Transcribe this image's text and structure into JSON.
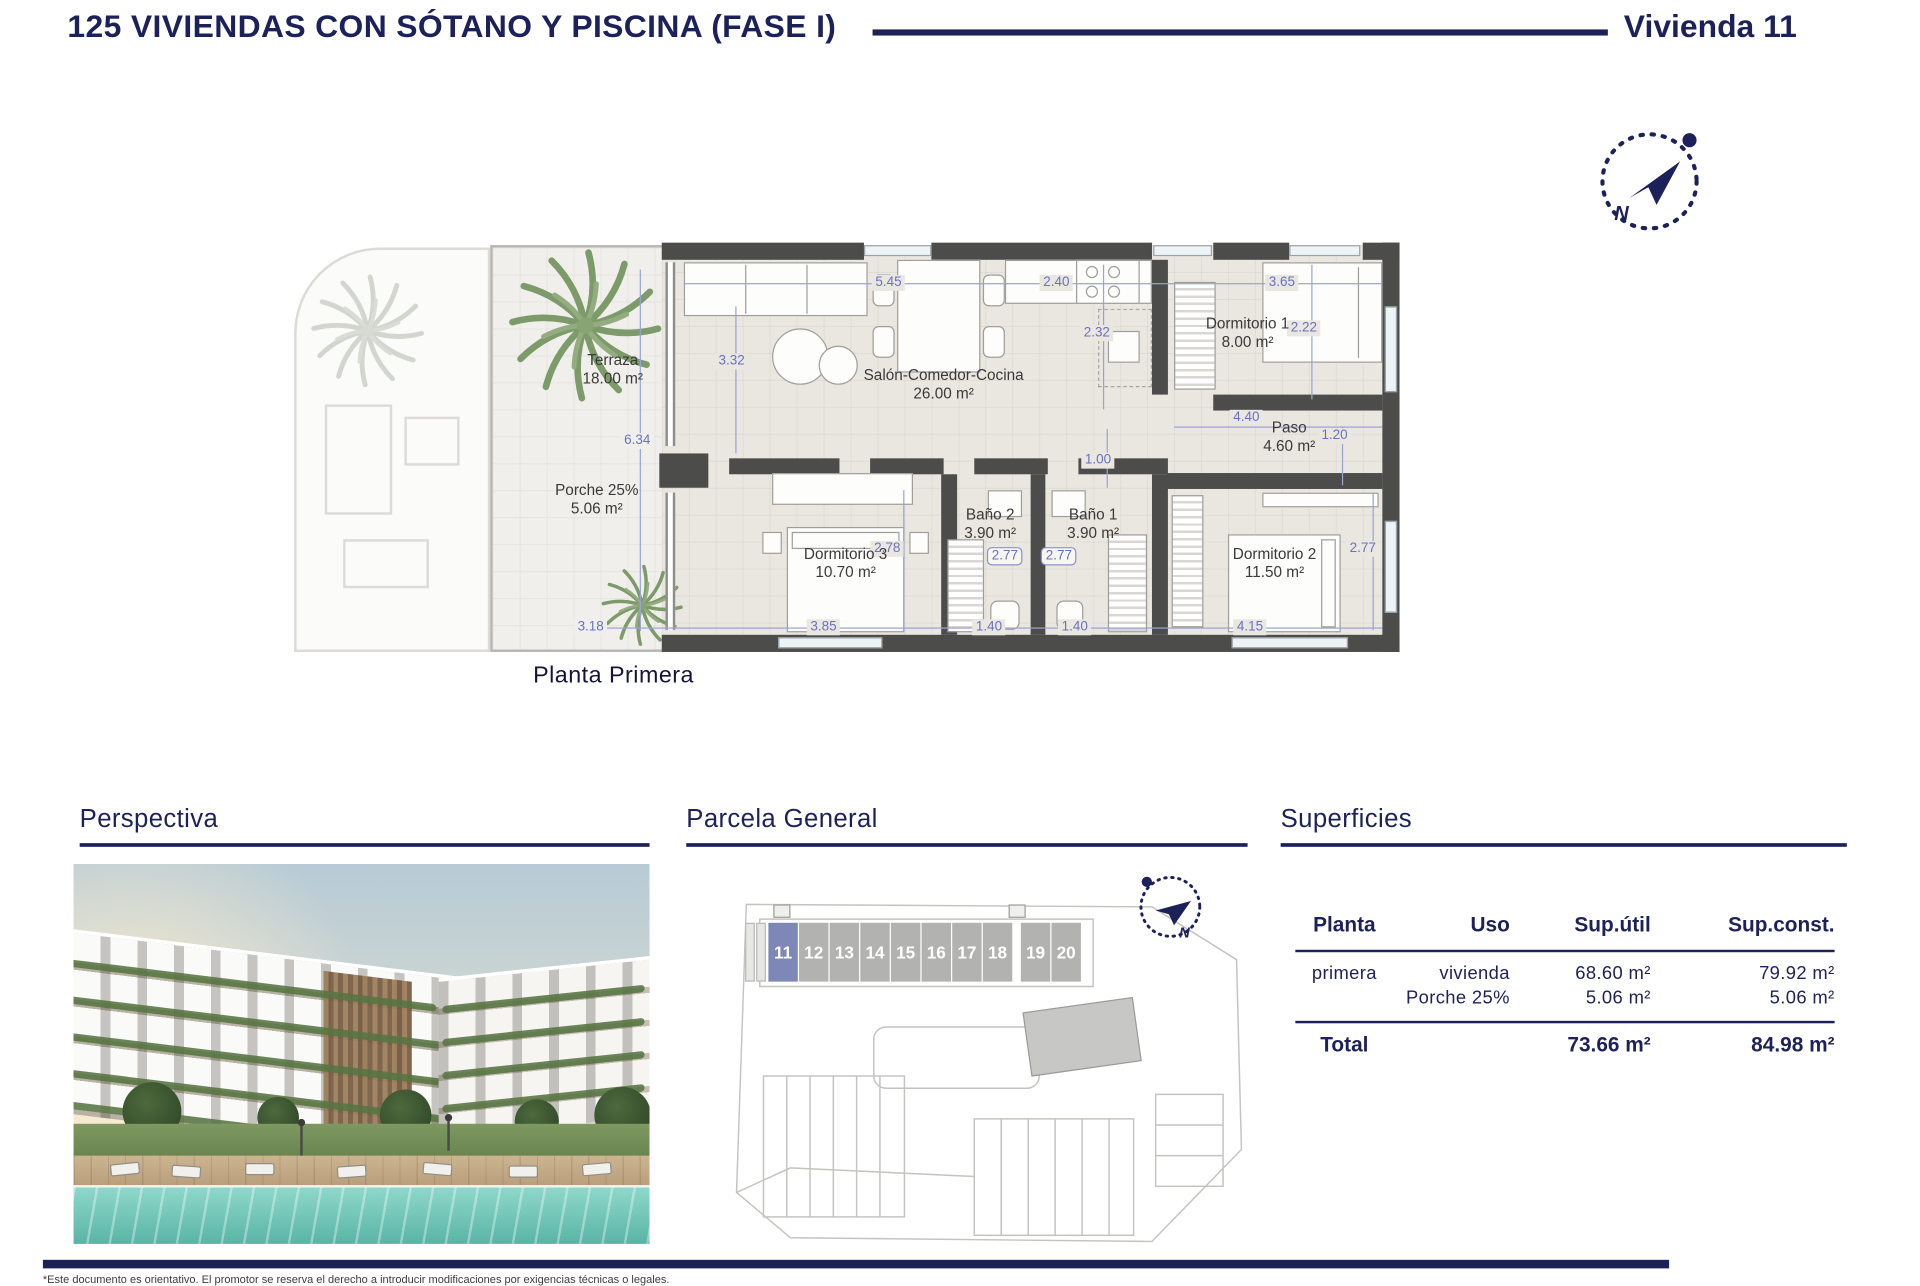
{
  "header": {
    "title": "125 VIVIENDAS CON SÓTANO Y PISCINA (FASE I)",
    "unit_label": "Vivienda 11"
  },
  "compass": {
    "north_label": "N"
  },
  "plan": {
    "caption": "Planta Primera",
    "rooms": [
      {
        "name": "Terraza",
        "area": "18.00 m²"
      },
      {
        "name": "Porche 25%",
        "area": "5.06 m²"
      },
      {
        "name": "Salón-Comedor-Cocina",
        "area": "26.00 m²"
      },
      {
        "name": "Dormitorio 1",
        "area": "8.00 m²"
      },
      {
        "name": "Paso",
        "area": "4.60 m²"
      },
      {
        "name": "Baño 2",
        "area": "3.90 m²"
      },
      {
        "name": "Baño 1",
        "area": "3.90 m²"
      },
      {
        "name": "Dormitorio 3",
        "area": "10.70 m²"
      },
      {
        "name": "Dormitorio 2",
        "area": "11.50 m²"
      }
    ],
    "dims": [
      "5.45",
      "2.40",
      "3.65",
      "2.32",
      "2.22",
      "3.32",
      "6.34",
      "4.40",
      "1.20",
      "1.00",
      "2.78",
      "2.77",
      "2.77",
      "2.77",
      "3.18",
      "3.85",
      "1.40",
      "1.40",
      "4.15"
    ]
  },
  "sections": {
    "perspectiva": {
      "heading": "Perspectiva"
    },
    "parcela": {
      "heading": "Parcela General",
      "units": [
        "11",
        "12",
        "13",
        "14",
        "15",
        "16",
        "17",
        "18",
        "19",
        "20"
      ],
      "highlighted_unit": "11"
    },
    "superficies": {
      "heading": "Superficies",
      "table": {
        "headers": [
          "Planta",
          "Uso",
          "Sup.útil",
          "Sup.const."
        ],
        "rows": [
          {
            "planta": "primera",
            "uso": "vivienda",
            "util": "68.60 m²",
            "const": "79.92 m²"
          },
          {
            "planta": "",
            "uso": "Porche 25%",
            "util": "5.06 m²",
            "const": "5.06 m²"
          }
        ],
        "total": {
          "label": "Total",
          "util": "73.66 m²",
          "const": "84.98 m²"
        }
      }
    }
  },
  "footer": {
    "disclaimer": "*Este documento es orientativo. El promotor se reserva el derecho a introducir modificaciones por exigencias técnicas o legales."
  },
  "colors": {
    "navy": "#1d2159",
    "dim_blue": "#6872c4",
    "wall": "#4c4c4a",
    "highlight_unit": "#7e88b6"
  }
}
